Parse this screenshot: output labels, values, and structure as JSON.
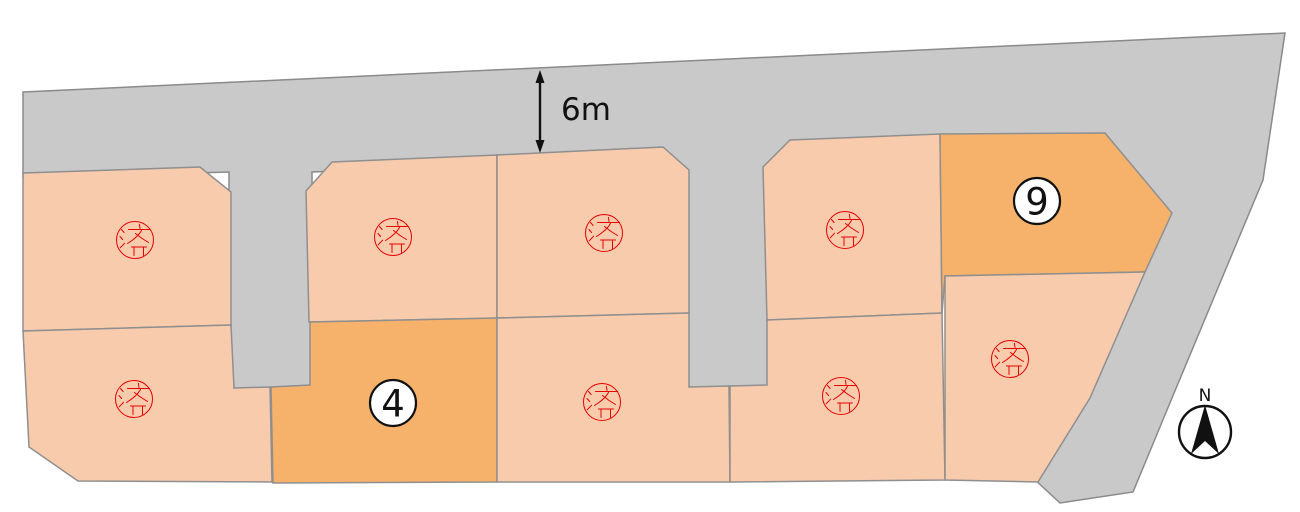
{
  "road": {
    "width_label": "6m"
  },
  "compass": {
    "north_label": "N"
  },
  "lots": [
    {
      "id": "top-1",
      "status": "sold",
      "label": "済"
    },
    {
      "id": "top-2",
      "status": "sold",
      "label": "済"
    },
    {
      "id": "top-3",
      "status": "sold",
      "label": "済"
    },
    {
      "id": "top-4",
      "status": "sold",
      "label": "済"
    },
    {
      "id": "top-5",
      "status": "available",
      "label": "9"
    },
    {
      "id": "bottom-1",
      "status": "sold",
      "label": "済"
    },
    {
      "id": "bottom-2",
      "status": "available",
      "label": "4"
    },
    {
      "id": "bottom-3",
      "status": "sold",
      "label": "済"
    },
    {
      "id": "bottom-4",
      "status": "sold",
      "label": "済"
    },
    {
      "id": "bottom-5",
      "status": "sold",
      "label": "済"
    }
  ],
  "colors": {
    "road_gray": "#c9c9c9",
    "sold_lot": "#f8cbad",
    "available_lot": "#f6b26b",
    "stamp_red": "#e60000"
  }
}
